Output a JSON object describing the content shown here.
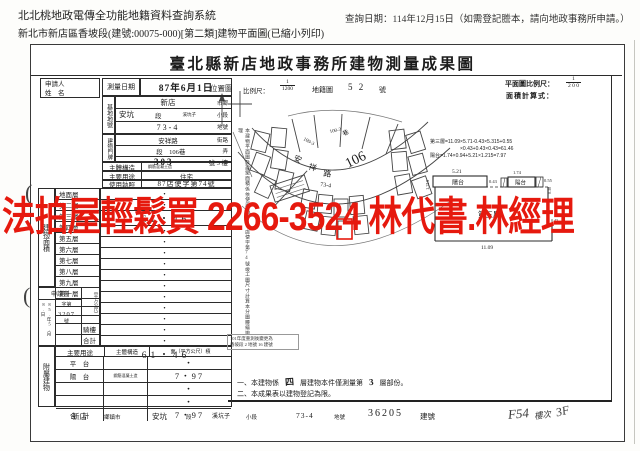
{
  "header": {
    "system_title": "北北桃地政電傳全功能地籍資料查詢系統",
    "query_date": "查詢日期：114年12月15日（如需登記謄本，請向地政事務所申請。）",
    "doc_line": "新北市新店區香坡段(建號:00075-000)[第二類]建物平面圖(已縮小列印)"
  },
  "sheet": {
    "title": "臺北縣新店地政事務所建物測量成果圖"
  },
  "applicant": {
    "line1": "申請人",
    "line2": "姓　名"
  },
  "survey": {
    "label": "測量日期",
    "value": "87年6月1日"
  },
  "site": {
    "label": "基地地號",
    "r1v": "新店",
    "r1u": "市鄉",
    "r2a": "安坑",
    "r2b": "段",
    "r2c": "溪坑子",
    "r2d": "小段",
    "r3v": "73-4",
    "r3u": "地號"
  },
  "door": {
    "label": "建物門牌",
    "r1v": "安祥路",
    "r1u": "街路",
    "r2v": "段　106巷",
    "r2u": "弄",
    "r3v": "303",
    "r3u": "號 3 樓"
  },
  "structure": {
    "label": "主體構造",
    "value": "鋼筋混凝土造"
  },
  "usage": {
    "label": "主要用途",
    "value": "住宅"
  },
  "license": {
    "label": "使用執照",
    "value": "87店使字第74號"
  },
  "area": {
    "label": "建物面積",
    "unit": "（平方公尺）",
    "floors": [
      {
        "name": "地面層",
        "value": "・"
      },
      {
        "name": "第二層",
        "value": "・"
      },
      {
        "name": "第三層",
        "value": "61・46"
      },
      {
        "name": "第四層",
        "value": "・"
      },
      {
        "name": "第五層",
        "value": "・"
      },
      {
        "name": "第六層",
        "value": "・"
      },
      {
        "name": "第七層",
        "value": "・"
      },
      {
        "name": "第八層",
        "value": "・"
      },
      {
        "name": "第九層",
        "value": "・"
      },
      {
        "name": "第十層",
        "value": "・"
      },
      {
        "name": "",
        "value": "・"
      },
      {
        "name": "",
        "value": "・"
      },
      {
        "name": "",
        "value": "・"
      },
      {
        "name": "騎樓",
        "value": "・"
      },
      {
        "name": "合計",
        "value": "61・46"
      }
    ]
  },
  "application": {
    "label": "申請書",
    "date": "85.年5.月8.日",
    "no_prefix": "字第",
    "no": "3207",
    "no_suffix": "號"
  },
  "annex": {
    "label": "附屬建物",
    "h1": "主要用途",
    "h2": "主體構造",
    "h3": "面（平方公尺）積",
    "rows": [
      {
        "use": "平　台",
        "structure": "",
        "area": "・"
      },
      {
        "use": "陽　台",
        "structure": "鋼筋混凝土造",
        "area": "7・97"
      },
      {
        "use": "",
        "structure": "",
        "area": "・"
      },
      {
        "use": "",
        "structure": "",
        "area": "・"
      },
      {
        "use": "合　計",
        "structure": "",
        "area": "7・97"
      }
    ]
  },
  "location_map": {
    "label": "位置圖",
    "scale_label": "比例尺：",
    "scale_num": "1",
    "scale_den": "1200",
    "cad_word": "地籍圖",
    "cad_no": "5 2",
    "cad_unit": "號",
    "road_char1": "安",
    "road_char2": "祥",
    "road_char3": "路",
    "lane": "106",
    "lane_word": "巷",
    "parcel_a": "109-3",
    "parcel_b": "100-3",
    "subject": "73-4"
  },
  "plan": {
    "scale_label": "平面圖比例尺：",
    "scale_num": "1",
    "scale_den": "2 0 0",
    "formula_label": "面積計算式：",
    "f1": "第三層=11.09×5.71-0.43×5.315+0.55",
    "f2": "×0.43+0.43×0.43=61.46",
    "f3": "陽台=1.74×0.94+5.21×1.215=7.97",
    "room": "第三層",
    "balcony1": "陽台",
    "balcony2": "陽台",
    "d_521": "5.21",
    "d_1215": "1.215",
    "d_043a": "0.43",
    "d_174": "1.74",
    "d_055": "0.55",
    "d_030": "0.30",
    "d_043b": "0.43",
    "d_1109": "11.09"
  },
  "stamp_note": {
    "line1": "101年度重測後變更為",
    "line2": "香坡段 2 地號 16 建號"
  },
  "notes": {
    "n1_pre": "一、本建物係",
    "n1_f1": "四",
    "n1_mid": "層建物本件僅測量第",
    "n1_f2": "3",
    "n1_post": "層部份。",
    "n2": "二、本成果表以建物登記為限。"
  },
  "vertical_note": "本建物平面圖及建築面積係依使用執照87店使字第74號竣工圖尺寸計算本分圖謄繪辦理",
  "bottom": {
    "v1": "新店",
    "u1": "鄉鎮市",
    "v2": "安坑",
    "u2": "段",
    "v3": "溪坑子",
    "u3": "小段",
    "v4": "73-4",
    "u4": "地號",
    "v5": "36205",
    "u5": "建號",
    "hw1": "F54",
    "hw2": "樓次",
    "hw3": "3F"
  },
  "watermark": {
    "text": "法拍屋輕鬆買 2266-3524 林代書.林經理",
    "color": "#e6190e"
  },
  "marks": {
    "paren": "("
  }
}
